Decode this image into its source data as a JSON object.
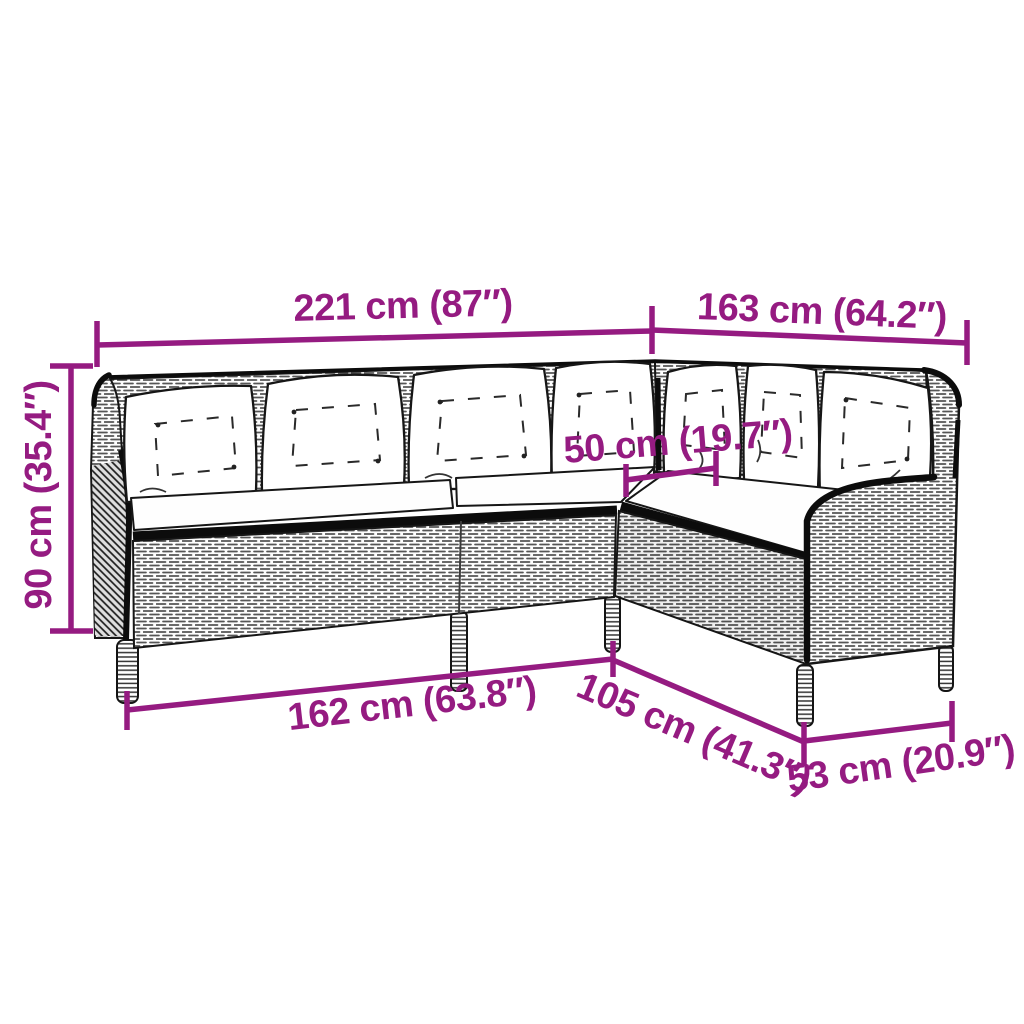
{
  "diagram": {
    "subject": "l-shaped-rattan-corner-sofa-line-drawing",
    "accent_color": "#951b81",
    "labels": {
      "total_width": "221 cm (87″)",
      "total_depth": "163 cm (64.2″)",
      "height": "90 cm (35.4″)",
      "seat_depth": "50 cm (19.7″)",
      "left_base_width": "162 cm (63.8″)",
      "right_base_depth": "105 cm (41.3″)",
      "arm_base_width": "53 cm (20.9″)"
    }
  }
}
